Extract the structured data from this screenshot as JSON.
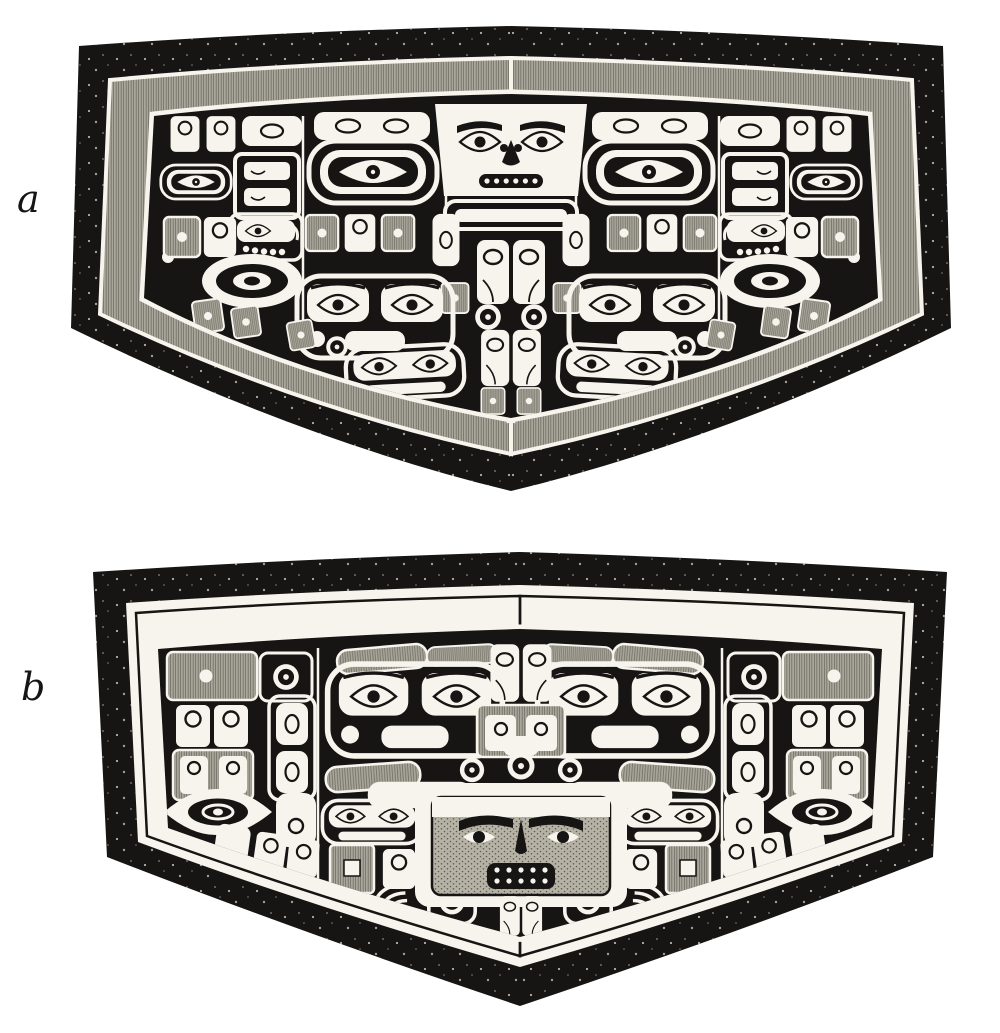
{
  "plate": {
    "type": "book-plate-engraving",
    "figures": [
      {
        "label": "a"
      },
      {
        "label": "b"
      }
    ]
  },
  "colors": {
    "page": "#ffffff",
    "ink": "#171513",
    "paper": "#f6f4ed",
    "hatch_base": "#a8a59a",
    "hatch_line": "#716e63",
    "stipple_base": "#b6b3a6",
    "stipple_dot": "#5d5a50"
  }
}
